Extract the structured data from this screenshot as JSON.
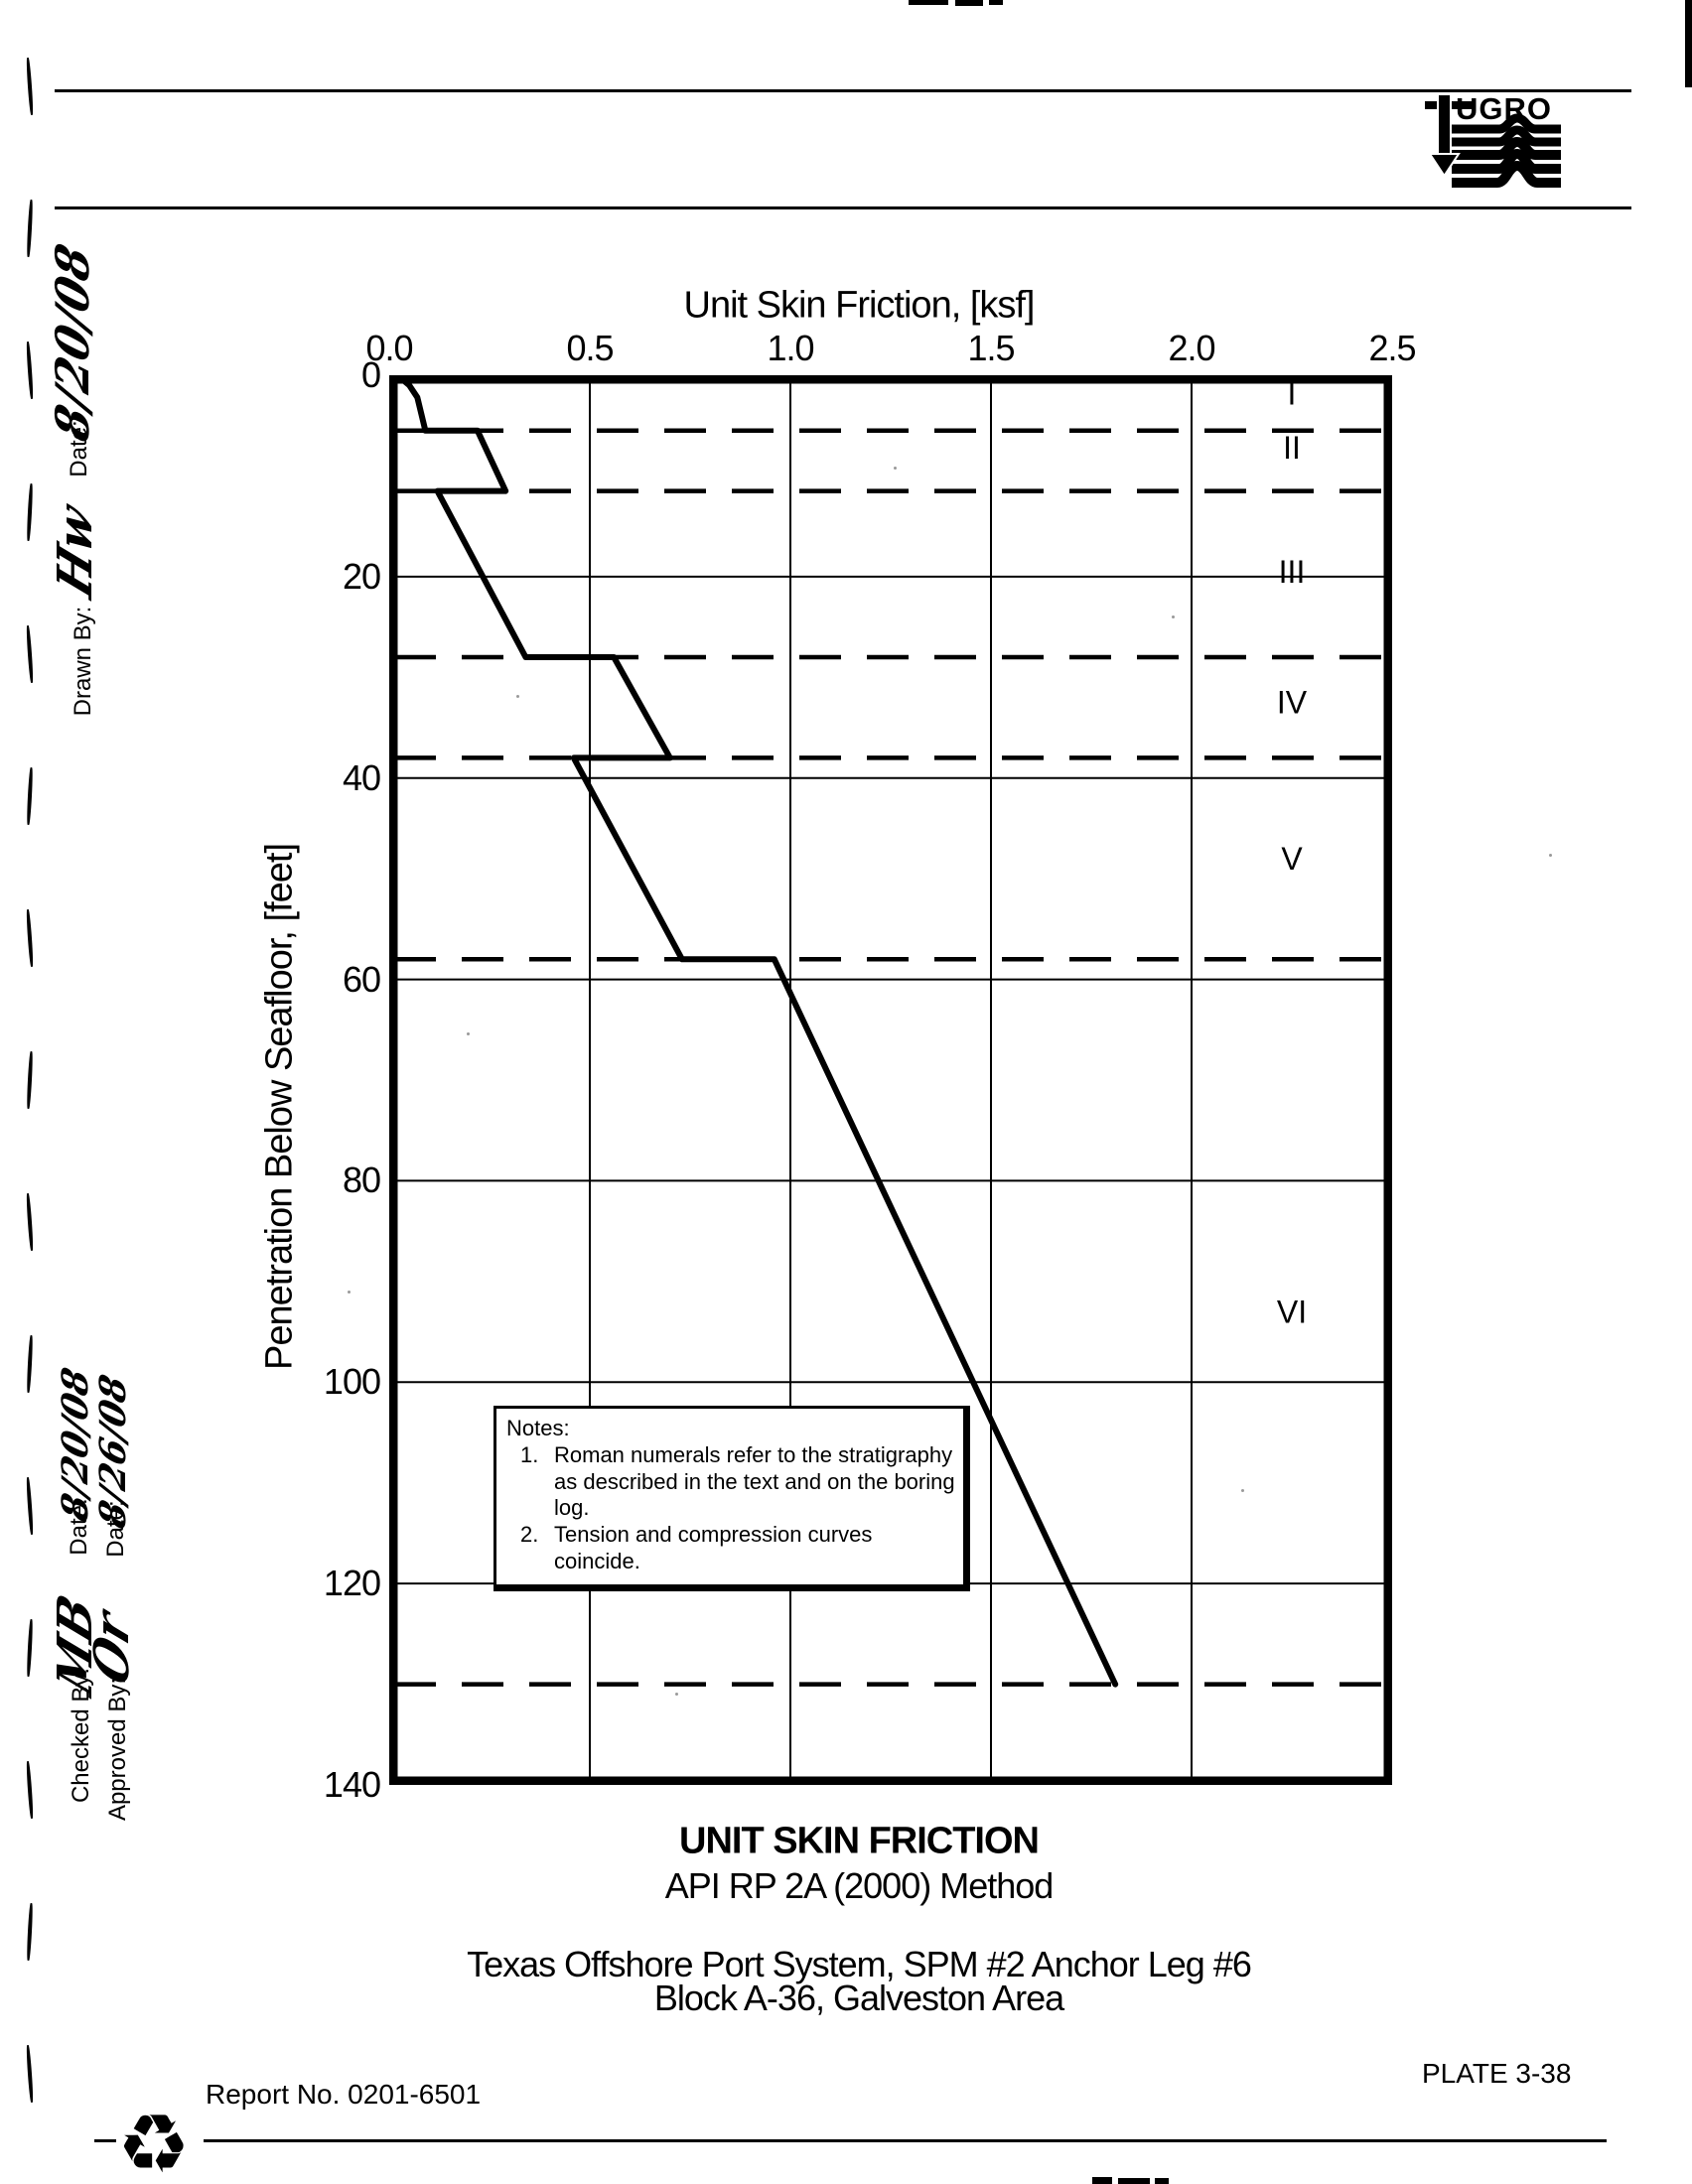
{
  "paper": {
    "ink": "#000000",
    "background": "#ffffff"
  },
  "header": {
    "logo_name": "FUGRO",
    "logo_wordmark": "UGRO"
  },
  "margin": {
    "upper": {
      "date_label": "Date:",
      "date_value": "8/20/08",
      "drawn_by_label": "Drawn By:",
      "drawn_by_signature": "Hw"
    },
    "lower": {
      "checked": {
        "date_label": "Date:",
        "date_value": "8/20/08",
        "by_label": "Checked By:",
        "by_value": "MB"
      },
      "approved": {
        "date_label": "Date:",
        "date_value": "8/26/08",
        "by_label": "Approved By:",
        "by_value": "Or"
      }
    }
  },
  "chart_data": {
    "type": "line",
    "xlabel": "Unit Skin Friction, [ksf]",
    "ylabel": "Penetration Below Seafloor, [feet]",
    "xlim": [
      0,
      2.5
    ],
    "ylim": [
      0,
      140
    ],
    "x_ticks": [
      0.0,
      0.5,
      1.0,
      1.5,
      2.0,
      2.5
    ],
    "x_tick_labels": [
      "0.0",
      "0.5",
      "1.0",
      "1.5",
      "2.0",
      "2.5"
    ],
    "y_ticks": [
      0,
      20,
      40,
      60,
      80,
      100,
      120,
      140
    ],
    "y_tick_labels": [
      "0",
      "20",
      "40",
      "60",
      "80",
      "100",
      "120",
      "140"
    ],
    "grid_x": [
      0.5,
      1.0,
      1.5,
      2.0
    ],
    "grid_y": [
      20,
      40,
      60,
      80,
      100,
      120
    ],
    "grid_on": true,
    "legend_position": "none",
    "stratum_boundaries_ft": [
      5.5,
      11.5,
      28,
      38,
      58,
      130
    ],
    "strata_labels": [
      {
        "label": "I",
        "depth_ft": 1.8
      },
      {
        "label": "II",
        "depth_ft": 7.2
      },
      {
        "label": "III",
        "depth_ft": 19.5
      },
      {
        "label": "IV",
        "depth_ft": 32.5
      },
      {
        "label": "V",
        "depth_ft": 48
      },
      {
        "label": "VI",
        "depth_ft": 93
      }
    ],
    "strata_label_x_ksf": 2.25,
    "series": [
      {
        "name": "Unit skin friction (tension and compression coincide)",
        "points_ksf_ft": [
          [
            0.02,
            0
          ],
          [
            0.05,
            1.0
          ],
          [
            0.07,
            2.2
          ],
          [
            0.09,
            5.5
          ],
          [
            0.22,
            5.5
          ],
          [
            0.29,
            11.5
          ],
          [
            0.12,
            11.5
          ],
          [
            0.34,
            28
          ],
          [
            0.56,
            28
          ],
          [
            0.7,
            38
          ],
          [
            0.46,
            38
          ],
          [
            0.73,
            58
          ],
          [
            0.96,
            58
          ],
          [
            1.81,
            130
          ]
        ]
      }
    ]
  },
  "notes": {
    "heading": "Notes:",
    "items": [
      {
        "num": "1.",
        "text": "Roman numerals refer to the stratigraphy as described in the text and on the boring log."
      },
      {
        "num": "2.",
        "text": "Tension and compression curves coincide."
      }
    ]
  },
  "captions": {
    "title": "UNIT SKIN FRICTION",
    "method": "API RP 2A (2000) Method",
    "project": "Texas Offshore Port System, SPM #2 Anchor Leg #6",
    "location": "Block A-36, Galveston Area"
  },
  "footer": {
    "report_no": "Report No. 0201-6501",
    "plate": "PLATE 3-38",
    "recycle_icon": "♻"
  }
}
